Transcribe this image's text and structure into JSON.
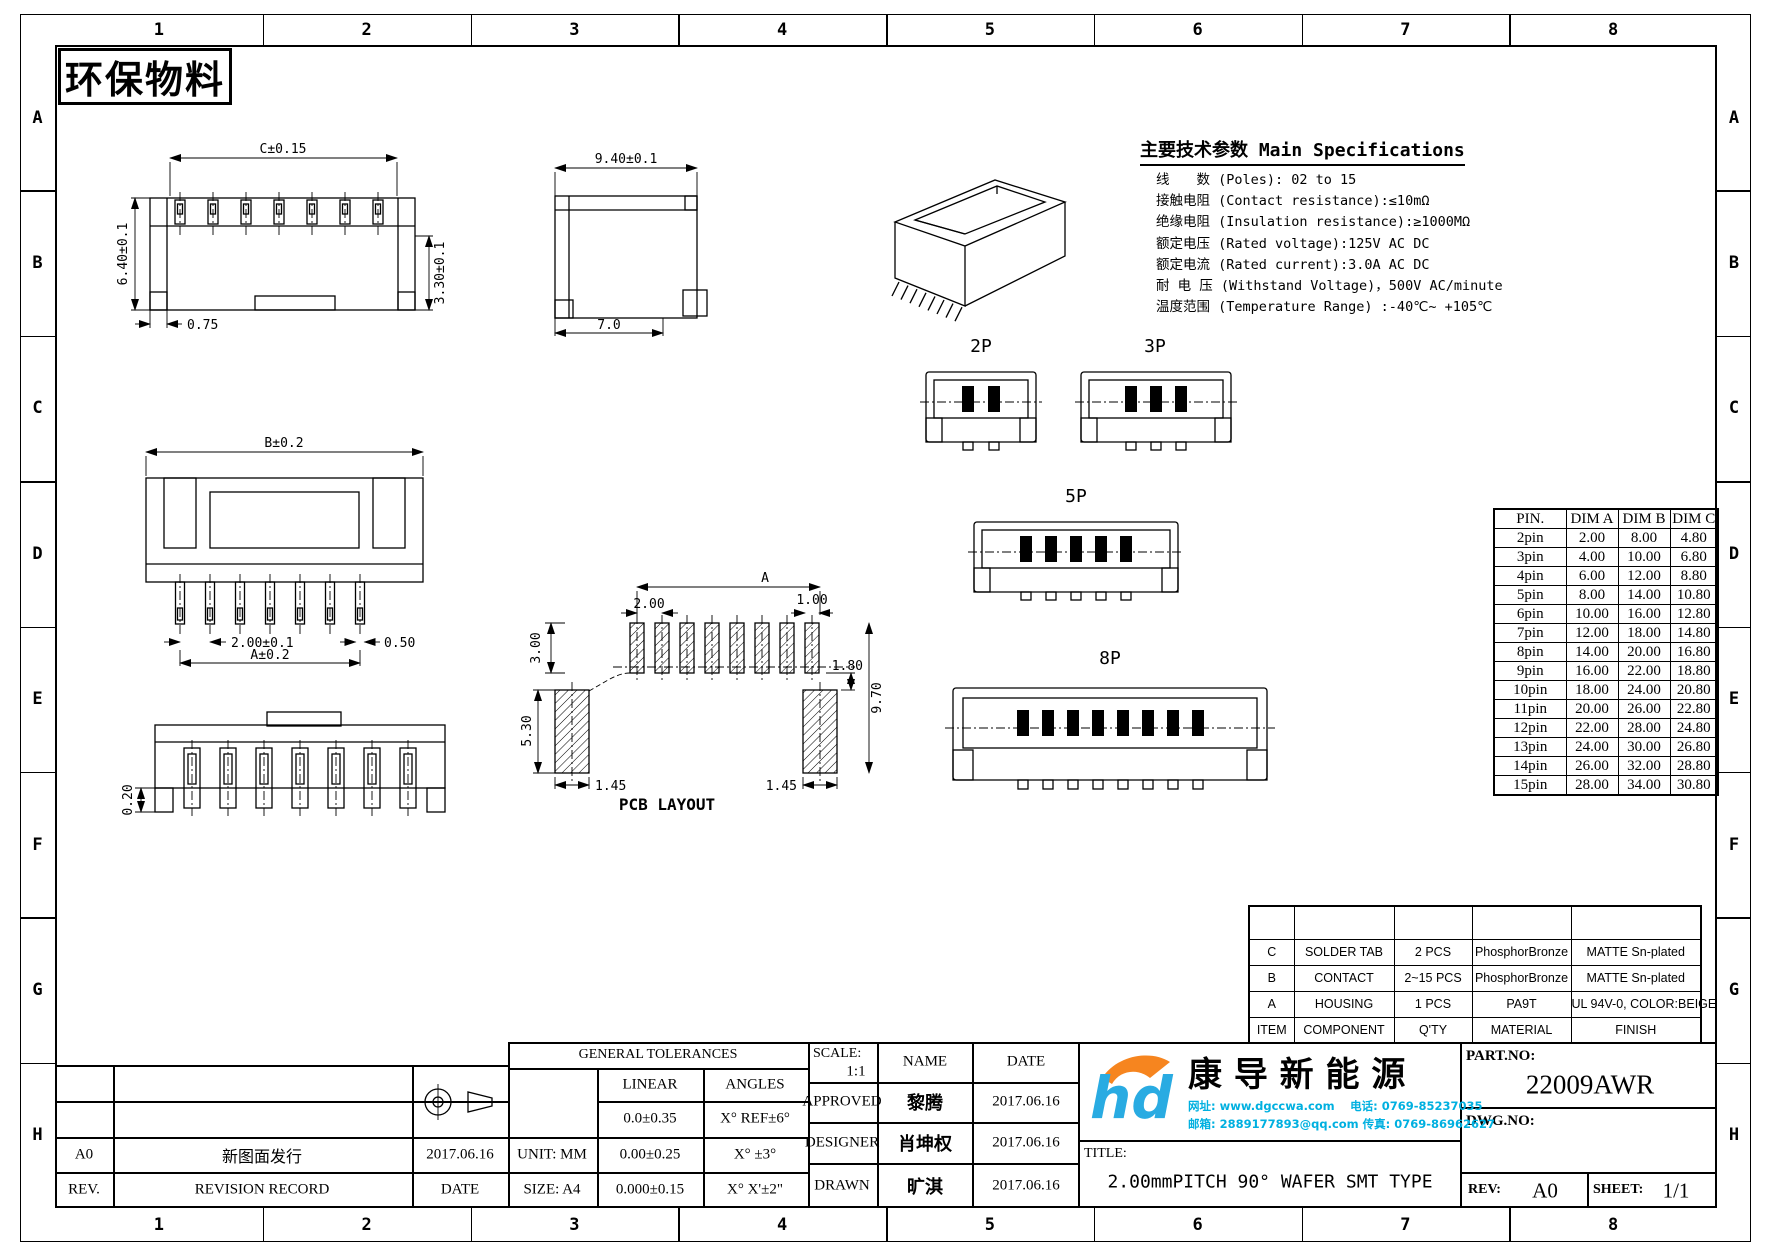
{
  "sheet": {
    "stamp": "环保物料",
    "cols": [
      "1",
      "2",
      "3",
      "4",
      "5",
      "6",
      "7",
      "8"
    ],
    "rows": [
      "A",
      "B",
      "C",
      "D",
      "E",
      "F",
      "G",
      "H"
    ]
  },
  "specs": {
    "title": "主要技术参数 Main Specifications",
    "lines": [
      "线　　数 (Poles): 02 to 15",
      "接触电阻 (Contact resistance):≤10mΩ",
      "绝缘电阻 (Insulation resistance):≥1000MΩ",
      "额定电压 (Rated voltage):125V AC DC",
      "额定电流 (Rated current):3.0A AC DC",
      "耐 电 压 (Withstand Voltage)，500V AC/minute",
      "温度范围 (Temperature Range) :-40℃~ +105℃"
    ]
  },
  "pin_table": {
    "headers": [
      "PIN.",
      "DIM A",
      "DIM B",
      "DIM C"
    ],
    "rows": [
      [
        "2pin",
        "2.00",
        "8.00",
        "4.80"
      ],
      [
        "3pin",
        "4.00",
        "10.00",
        "6.80"
      ],
      [
        "4pin",
        "6.00",
        "12.00",
        "8.80"
      ],
      [
        "5pin",
        "8.00",
        "14.00",
        "10.80"
      ],
      [
        "6pin",
        "10.00",
        "16.00",
        "12.80"
      ],
      [
        "7pin",
        "12.00",
        "18.00",
        "14.80"
      ],
      [
        "8pin",
        "14.00",
        "20.00",
        "16.80"
      ],
      [
        "9pin",
        "16.00",
        "22.00",
        "18.80"
      ],
      [
        "10pin",
        "18.00",
        "24.00",
        "20.80"
      ],
      [
        "11pin",
        "20.00",
        "26.00",
        "22.80"
      ],
      [
        "12pin",
        "22.00",
        "28.00",
        "24.80"
      ],
      [
        "13pin",
        "24.00",
        "30.00",
        "26.80"
      ],
      [
        "14pin",
        "26.00",
        "32.00",
        "28.80"
      ],
      [
        "15pin",
        "28.00",
        "34.00",
        "30.80"
      ]
    ]
  },
  "bom": {
    "rows": [
      [
        "",
        "",
        "",
        "",
        ""
      ],
      [
        "C",
        "SOLDER TAB",
        "2 PCS",
        "PhosphorBronze",
        "MATTE Sn-plated"
      ],
      [
        "B",
        "CONTACT",
        "2~15 PCS",
        "PhosphorBronze",
        "MATTE Sn-plated"
      ],
      [
        "A",
        "HOUSING",
        "1 PCS",
        "PA9T",
        "UL 94V-0, COLOR:BEIGE"
      ],
      [
        "ITEM",
        "COMPONENT",
        "Q'TY",
        "MATERIAL",
        "FINISH"
      ]
    ]
  },
  "dims": {
    "side": {
      "width": "C±0.15",
      "height": "6.40±0.1",
      "pin_h": "3.30±0.1",
      "offset": "0.75"
    },
    "end": {
      "depth": "9.40±0.1",
      "body": "7.0"
    },
    "front": {
      "width": "B±0.2",
      "pitch": "2.00±0.1",
      "pin_w": "0.50",
      "span": "A±0.2"
    },
    "front2": {
      "thickness": "0.20"
    },
    "pcb": {
      "span": "A",
      "pitch": "2.00",
      "pad_w": "1.00",
      "pad_h": "3.00",
      "tab_h": "5.30",
      "edge_l": "1.45",
      "edge_r": "1.45",
      "gap": "1.80",
      "total": "9.70",
      "label": "PCB LAYOUT"
    }
  },
  "variants": [
    {
      "label": "2P"
    },
    {
      "label": "3P"
    },
    {
      "label": "5P"
    },
    {
      "label": "8P"
    }
  ],
  "title_block": {
    "rev_value": "A0",
    "rev_record": "新图面发行",
    "rev_date": "2017.06.16",
    "rev_label": "REV.",
    "record_label": "REVISION RECORD",
    "date_label": "DATE",
    "unit": "UNIT: MM",
    "size": "SIZE: A4",
    "tol_title": "GENERAL TOLERANCES",
    "tol_linear": "LINEAR",
    "tol_angles": "ANGLES",
    "tol_rows": [
      [
        "0.0±0.35",
        "X° REF±6°"
      ],
      [
        "0.00±0.25",
        "X° ±3°"
      ],
      [
        "0.000±0.15",
        "X° X'±2\""
      ]
    ],
    "scale_label": "SCALE:",
    "scale": "1:1",
    "name_label": "NAME",
    "date_col_label": "DATE",
    "signs": [
      [
        "APPROVED",
        "黎腾",
        "2017.06.16"
      ],
      [
        "DESIGNER",
        "肖坤权",
        "2017.06.16"
      ],
      [
        "DRAWN",
        "旷淇",
        "2017.06.16"
      ]
    ],
    "title_label": "TITLE:",
    "title": "2.00mmPITCH 90° WAFER SMT TYPE",
    "part_label": "PART.NO:",
    "part_no": "22009AWR",
    "dwg_label": "DWG.NO:",
    "rev2_label": "REV:",
    "rev2": "A0",
    "sheet_label": "SHEET:",
    "sheet_no": "1/1"
  },
  "company": {
    "name": "康 导 新 能 源",
    "contact1": "网址: www.dgccwa.com　 电话: 0769-85237035",
    "contact2": "邮箱: 2889177893@qq.com 传真: 0769-86962627"
  },
  "colors": {
    "logo_blue": "#29abe2",
    "logo_orange": "#f6851f",
    "contact_cyan": "#00b0e0"
  }
}
